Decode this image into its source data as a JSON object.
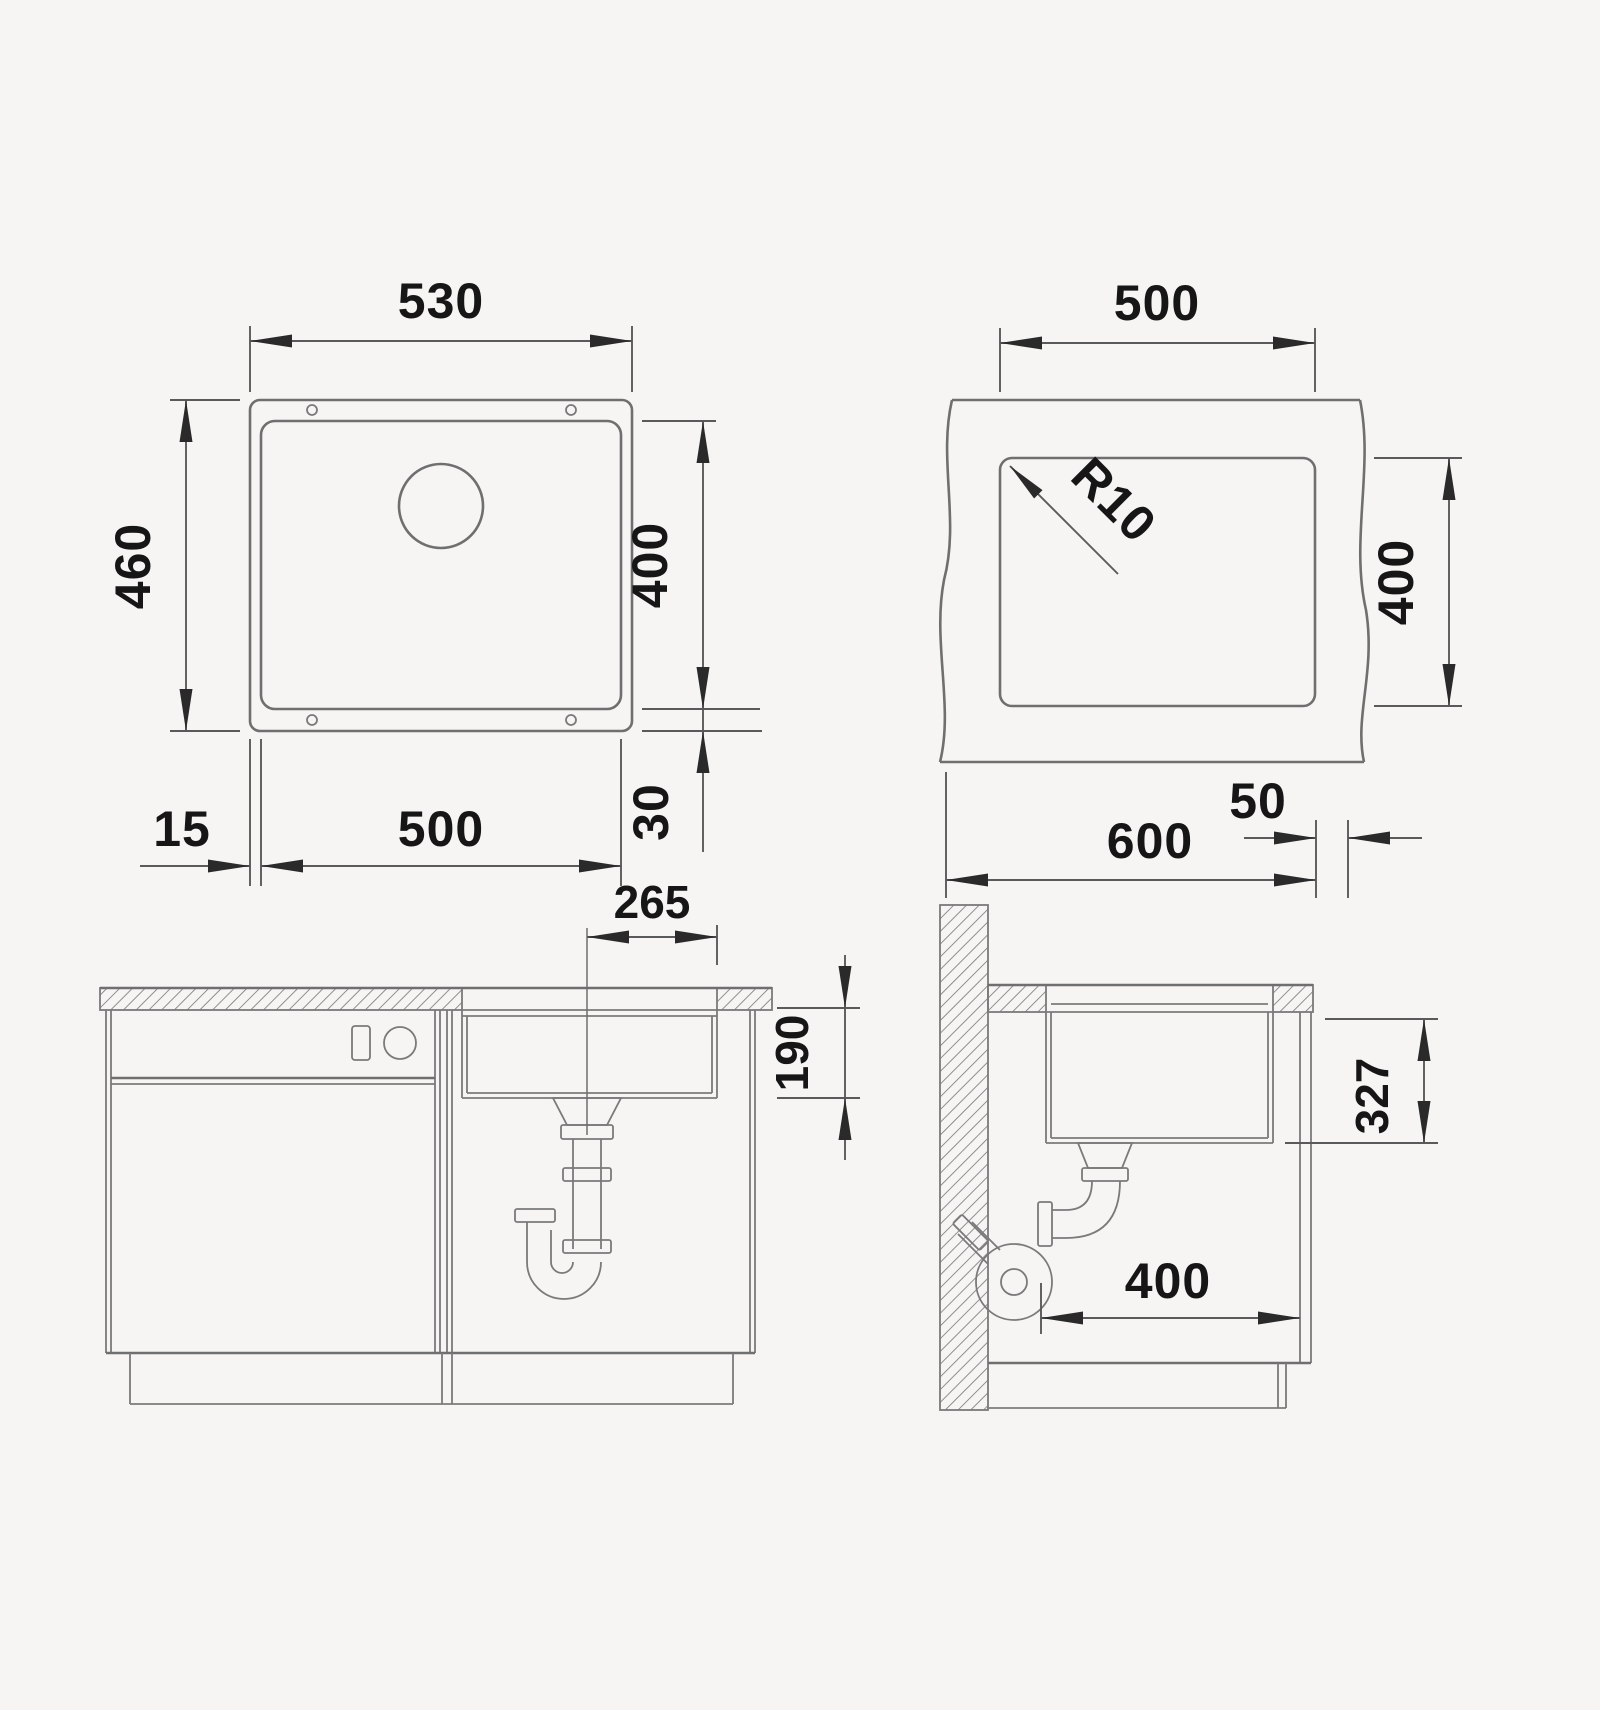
{
  "drawing": {
    "type": "sink-installation-technical-drawing",
    "colors": {
      "background": "#f6f5f4",
      "object_line": "#6f6f6f",
      "dimension_line": "#5a5a5a",
      "text": "#161616"
    },
    "plan_view": {
      "outer_width": "530",
      "outer_depth": "460",
      "bowl_height": "400",
      "bowl_width": "500",
      "rim_offset_left": "15",
      "rim_offset_bottom": "30"
    },
    "cutout_view": {
      "cutout_width": "500",
      "corner_radius": "R10",
      "cutout_depth": "400",
      "cabinet_width": "600",
      "edge_offset": "50"
    },
    "front_view": {
      "drain_offset": "265",
      "bowl_depth": "190"
    },
    "side_view": {
      "under_counter_depth": "327",
      "clearance_depth": "400"
    }
  }
}
